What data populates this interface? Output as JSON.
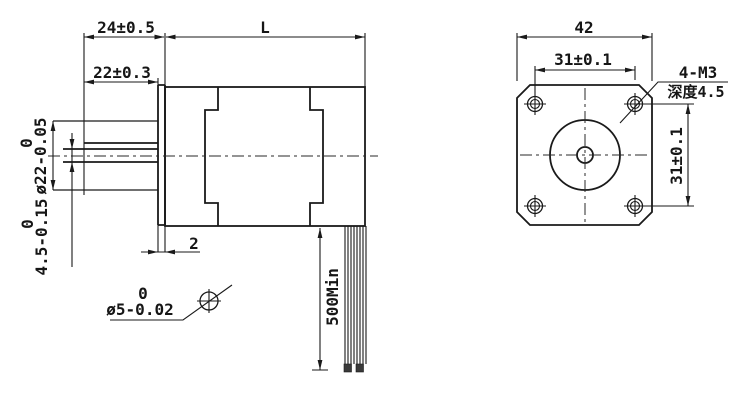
{
  "side_view": {
    "dim_shaft_total": "24±0.5",
    "dim_body_length": "L",
    "dim_shaft_front": "22±0.3",
    "boss_dia_upper": "0",
    "boss_dia": "ø22-0.05",
    "flat_upper": "0",
    "flat": "4.5-0.15",
    "shaft_dia_upper": "0",
    "shaft_dia": "ø5-0.02",
    "dim_flange_thickness": "2",
    "dim_wire_length": "500Min"
  },
  "front_view": {
    "dim_width": "42",
    "dim_hole_spacing_top": "31±0.1",
    "dim_hole_spacing_side": "31±0.1",
    "thread_spec": "4-M3",
    "thread_depth": "深度4.5"
  },
  "colors": {
    "line": "#1a1a1a",
    "background": "#ffffff"
  }
}
